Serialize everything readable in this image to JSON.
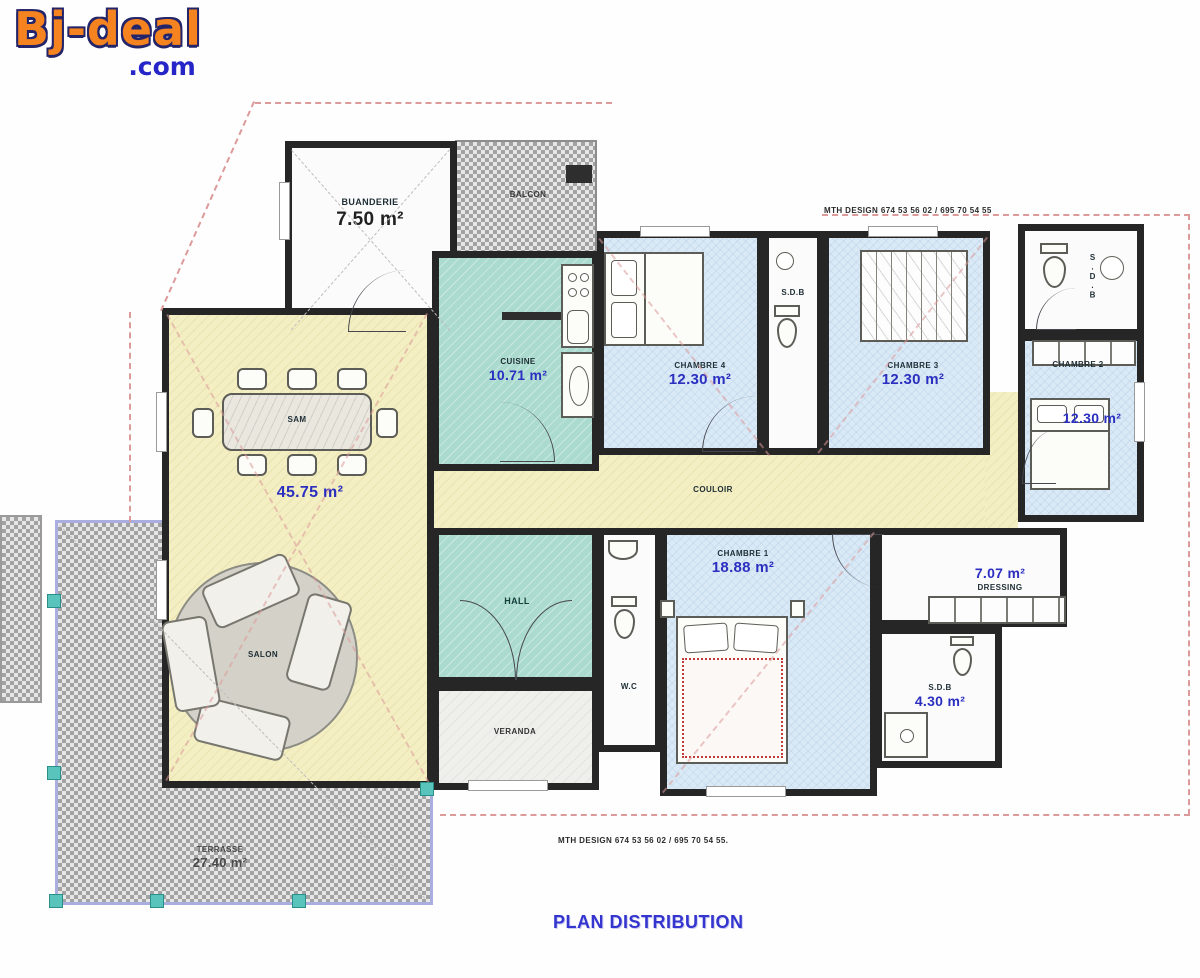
{
  "logo": {
    "brand": "Bj-deal",
    "tld": ".com"
  },
  "title": "PLAN DISTRIBUTION",
  "credit_top": "MTH DESIGN 674 53 56 02 / 695 70 54 55",
  "credit_bottom": "MTH DESIGN 674 53 56 02 / 695 70 54 55.",
  "rooms": {
    "buanderie": {
      "name": "BUANDERIE",
      "area": "7.50 m²"
    },
    "balcon": {
      "name": "BALCON"
    },
    "cuisine": {
      "name": "CUISINE",
      "area": "10.71 m²"
    },
    "chambre4": {
      "name": "CHAMBRE 4",
      "area": "12.30 m²"
    },
    "sdb1": {
      "name": "S.D.B"
    },
    "chambre3": {
      "name": "CHAMBRE 3",
      "area": "12.30 m²"
    },
    "sdb2": {
      "name": "S.D.B"
    },
    "chambre2": {
      "name": "CHAMBRE 2",
      "area": "12.30 m²"
    },
    "couloir": {
      "name": "COULOIR"
    },
    "sam": {
      "name": "SAM"
    },
    "salon": {
      "name": "SALON",
      "area": "45.75 m²"
    },
    "hall": {
      "name": "HALL"
    },
    "veranda": {
      "name": "VERANDA"
    },
    "wc": {
      "name": "W.C"
    },
    "chambre1": {
      "name": "CHAMBRE 1",
      "area": "18.88 m²"
    },
    "dressing": {
      "name": "DRESSING",
      "area": "7.07 m²"
    },
    "sdb3": {
      "name": "S.D.B",
      "area": "4.30 m²"
    },
    "terrasse": {
      "name": "TERRASSE",
      "area": "27.40 m²"
    }
  },
  "colors": {
    "accent_orange": "#f5831f",
    "accent_blue": "#2525c8",
    "area_text": "#2b2fc0",
    "wall": "#262626",
    "room_blue": "#d9e9f6",
    "room_teal": "#abdacf",
    "room_yellow": "#f4efc2",
    "roof_dash": "#dc9a9a",
    "column_teal": "#58c4bc"
  }
}
